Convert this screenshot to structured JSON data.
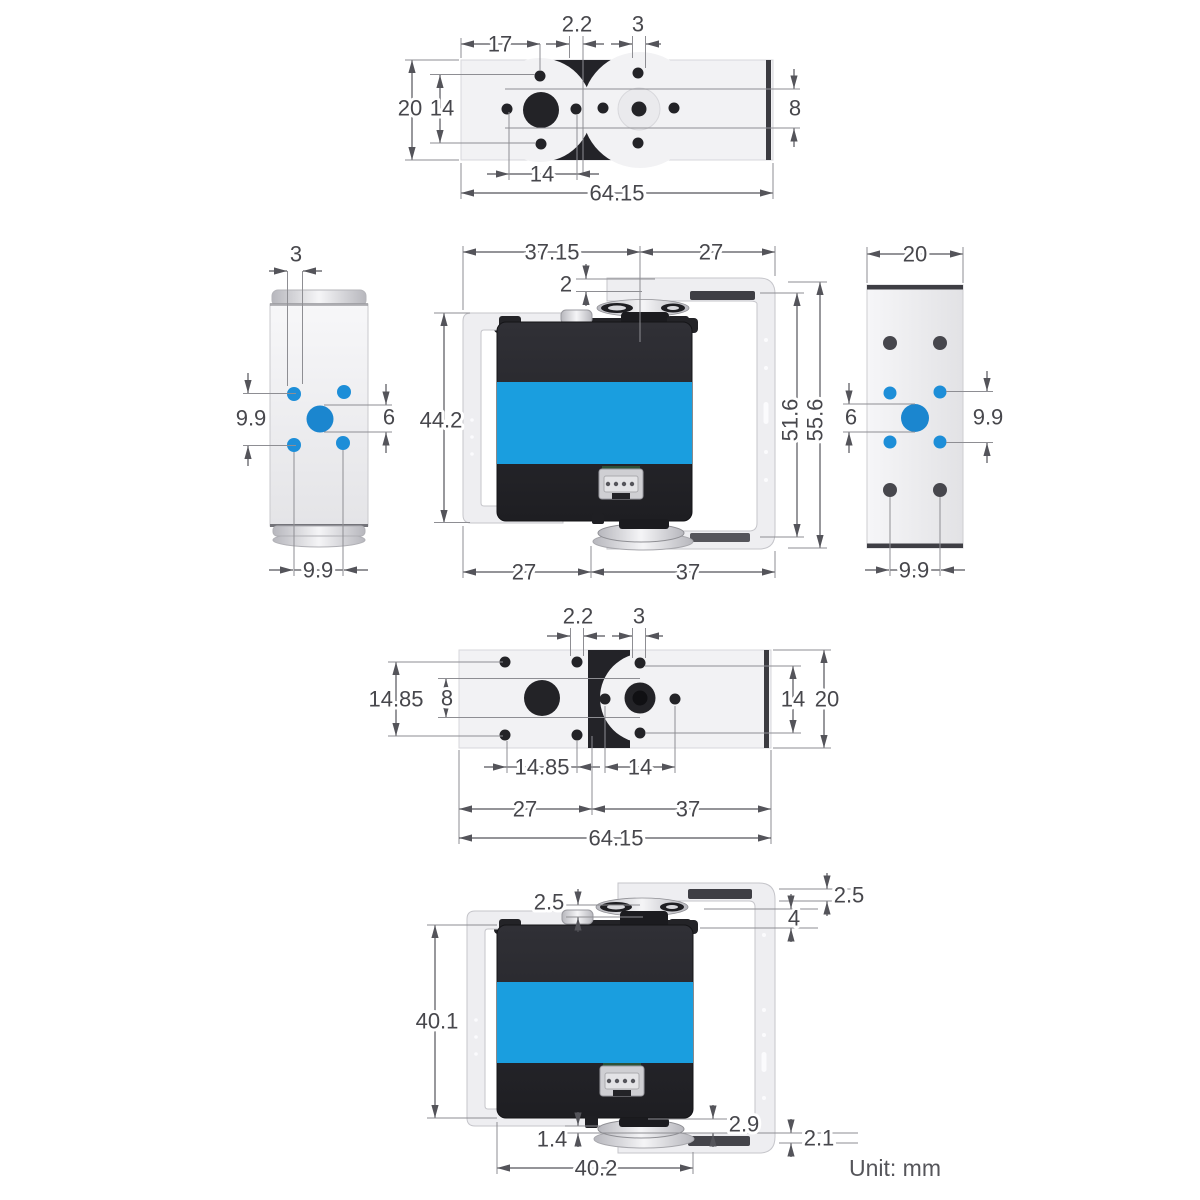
{
  "unit_label": "Unit: mm",
  "colors": {
    "accent_blue_band": "#1a9edf",
    "hole_blue_small": "#1d8ed8",
    "hole_blue_big": "#1b86cf",
    "servo_body_dark": "#232328",
    "dim_text": "#47474c"
  },
  "views": {
    "top_plate": {
      "dims": {
        "w17": "17",
        "hole2_2": "2.2",
        "hole3": "3",
        "h20": "20",
        "h14": "14",
        "h8": "8",
        "w14": "14",
        "w64_15": "64.15"
      }
    },
    "side_left": {
      "dims": {
        "hole3": "3",
        "v9_9": "9.9",
        "hole6": "6",
        "h9_9": "9.9"
      }
    },
    "front": {
      "dims": {
        "w37_15": "37.15",
        "w27": "27",
        "g2": "2",
        "h44_2": "44.2",
        "h51_6": "51.6",
        "h55_6": "55.6",
        "b27": "27",
        "b37": "37"
      }
    },
    "side_right": {
      "dims": {
        "w20": "20",
        "hole6": "6",
        "v9_9": "9.9",
        "h9_9": "9.9"
      }
    },
    "bottom_plate": {
      "dims": {
        "hole2_2": "2.2",
        "hole3": "3",
        "v14_85": "14.85",
        "v8": "8",
        "v14": "14",
        "v20": "20",
        "w14_85": "14.85",
        "w14": "14",
        "w27": "27",
        "w37": "37",
        "w64_15": "64.15"
      }
    },
    "rear": {
      "dims": {
        "g2_5_left": "2.5",
        "g2_5_right": "2.5",
        "g4": "4",
        "h40_1": "40.1",
        "g2_9": "2.9",
        "g1_4": "1.4",
        "g2_1": "2.1",
        "w40_2": "40.2"
      }
    }
  }
}
